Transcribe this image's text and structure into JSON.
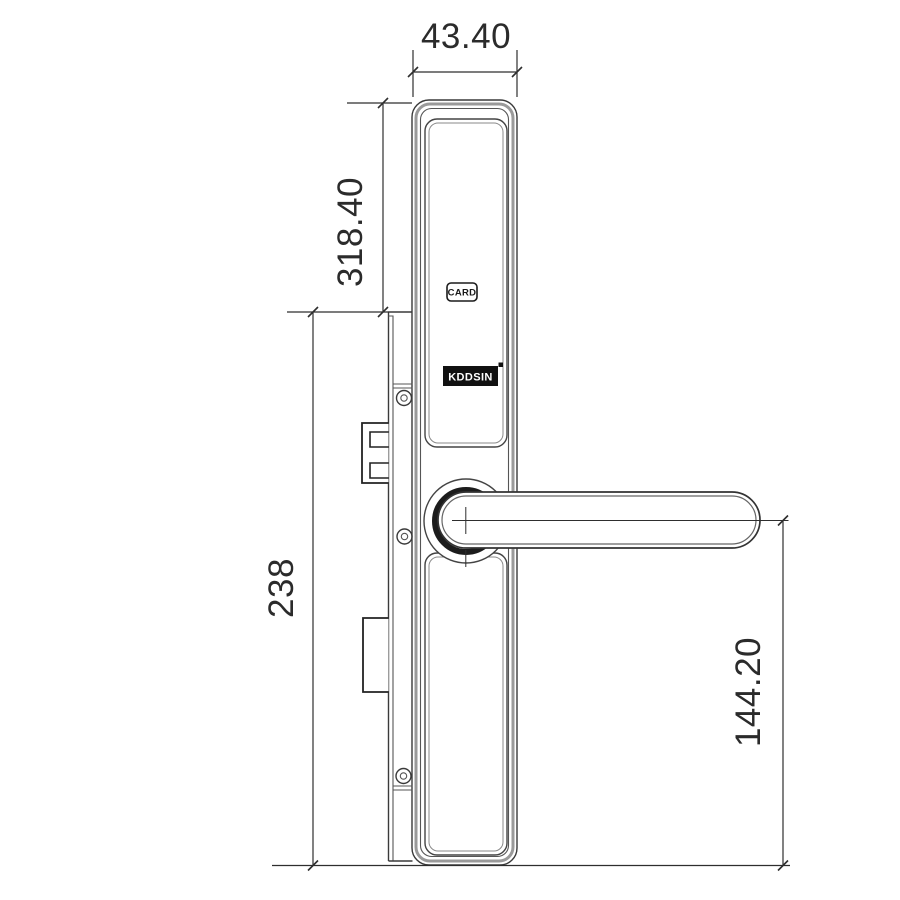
{
  "drawing": {
    "type": "technical-dimension-drawing",
    "subject": "smart door lock with lever handle, side elevation",
    "dimensions": {
      "body_width": "43.40",
      "body_height": "318.40",
      "mortise_height": "238",
      "handle_axis_to_bottom": "144.20"
    },
    "labels": {
      "card_slot": "CARD",
      "brand_logo": "KDDSIN"
    },
    "colors": {
      "background": "#ffffff",
      "line": "#3a3a3a",
      "thick_line": "#9a9a9a",
      "dimension_text": "#2b2b2b",
      "logo_background": "#111111",
      "logo_text": "#ffffff"
    }
  }
}
